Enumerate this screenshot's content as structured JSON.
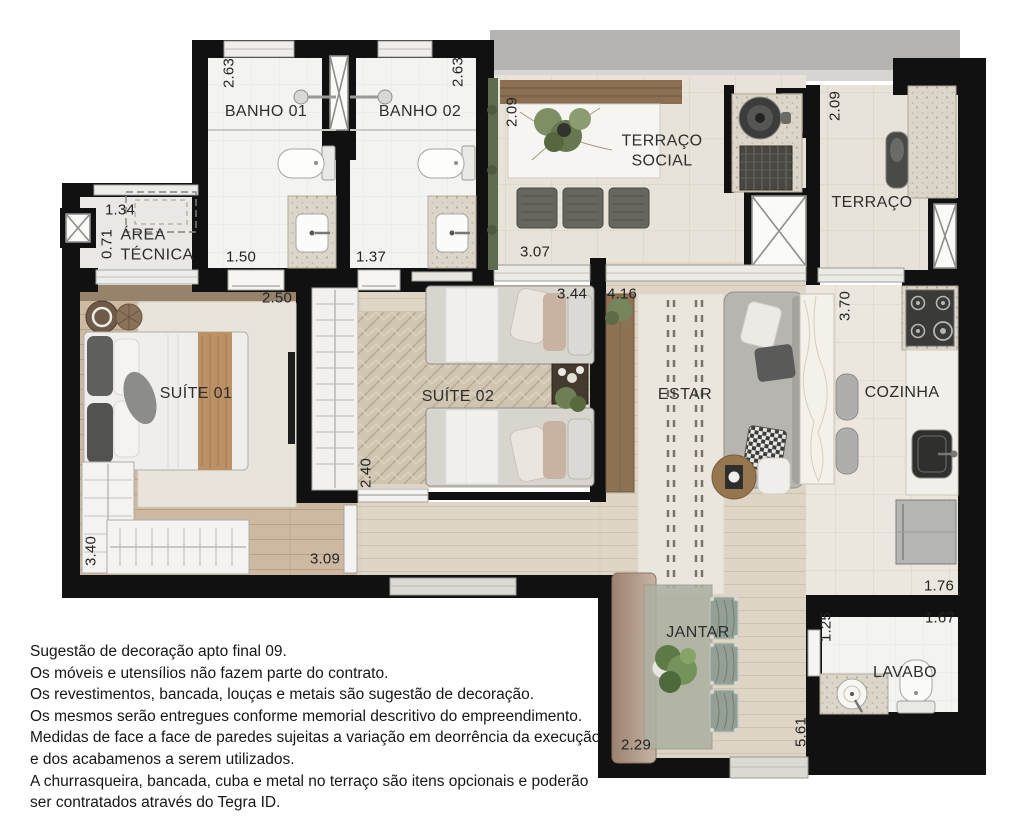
{
  "plan": {
    "title": "Planta apto final 09",
    "rooms": {
      "banho01": {
        "label": "BANHO 01",
        "width": "1.50",
        "height": "2.63"
      },
      "banho02": {
        "label": "BANHO 02",
        "width": "1.37",
        "height": "2.63"
      },
      "area_tecnica": {
        "label": "ÁREA\nTÉCNICA",
        "width": "1.34",
        "height": "0.71"
      },
      "terraco_social": {
        "label": "TERRAÇO\nSOCIAL",
        "width": "3.07",
        "height": "2.09"
      },
      "terraco": {
        "label": "TERRAÇO",
        "height": "2.09"
      },
      "suite01": {
        "label": "SUÍTE 01",
        "width": "2.50",
        "height": "3.40"
      },
      "suite02": {
        "label": "SUÍTE 02",
        "width": "3.44",
        "height": "2.40"
      },
      "corridor": {
        "width": "3.09"
      },
      "estar": {
        "label": "ESTAR",
        "width": "4.16"
      },
      "cozinha": {
        "label": "COZINHA",
        "width": "1.76",
        "height": "3.70"
      },
      "jantar": {
        "label": "JANTAR",
        "width": "2.29",
        "height": "5.61"
      },
      "lavabo": {
        "label": "LAVABO",
        "width": "1.67",
        "height": "1.25"
      }
    },
    "colors": {
      "wall": "#111111",
      "wood_warm": "#cdb8a1",
      "wood_pale": "#ded5c6",
      "tile_white": "#f3f3f1",
      "tile_terrace": "#e8e3d8",
      "rug_cream": "#e9e4da",
      "accent_green": "#6d7f55",
      "rail_gray": "#b5b4b1"
    }
  },
  "disclaimer": {
    "lines": [
      "Sugestão de decoração apto final 09.",
      "Os móveis e utensílios não fazem parte do contrato.",
      "Os revestimentos, bancada, louças e metais são sugestão de decoração.",
      "Os mesmos serão entregues conforme memorial descritivo do empreendimento.",
      "Medidas de face a face de paredes sujeitas a variação em deorrência da execução",
      "e dos acabamenos a serem utilizados.",
      "A churrasqueira, bancada, cuba e metal no terraço são itens opcionais e poderão",
      "ser contratados através do Tegra ID."
    ]
  }
}
